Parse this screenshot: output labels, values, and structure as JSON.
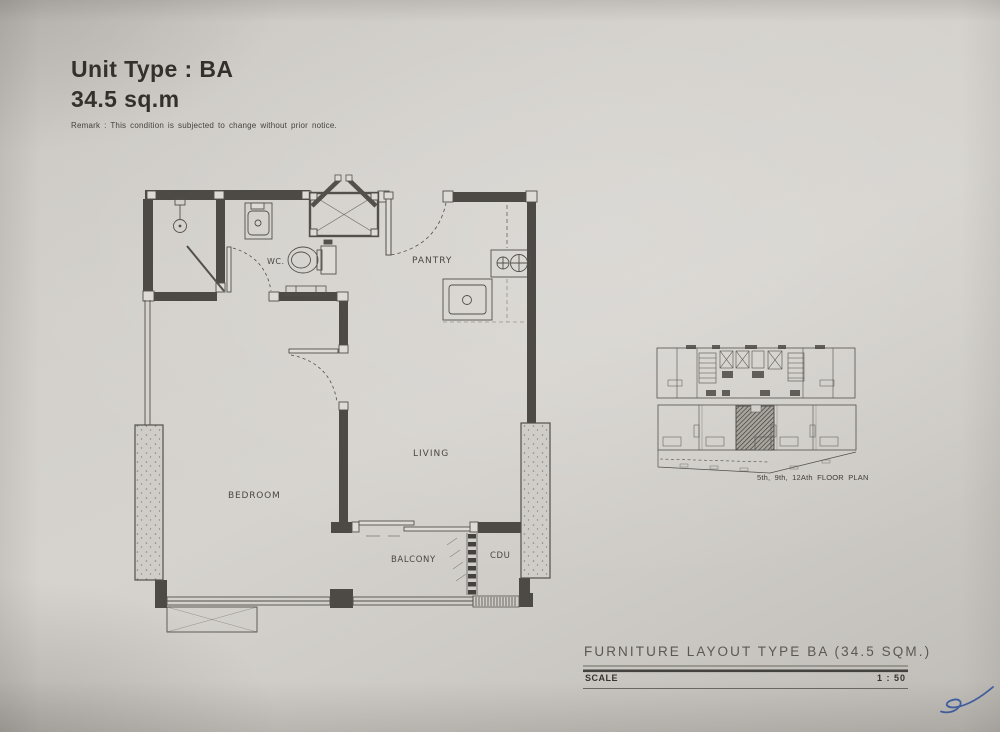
{
  "header": {
    "title": "Unit Type : BA",
    "area": "34.5 sq.m",
    "remark": "Remark : This condition is subjected to change without prior notice."
  },
  "floor_plan": {
    "rooms": {
      "wc": "WC.",
      "pantry": "PANTRY",
      "living": "LIVING",
      "bedroom": "BEDROOM",
      "balcony": "BALCONY",
      "cdu": "CDU"
    }
  },
  "key_plan": {
    "caption": "5th, 9th, 12Ath FLOOR PLAN"
  },
  "title_block": {
    "title": "FURNITURE LAYOUT TYPE BA (34.5 SQM.)",
    "scale_label": "SCALE",
    "scale_value": "1 : 50"
  },
  "colors": {
    "paper": "#d2cfca",
    "line": "#53504b",
    "wall": "#4d4a45",
    "signature_blue": "#3f5fa4"
  }
}
